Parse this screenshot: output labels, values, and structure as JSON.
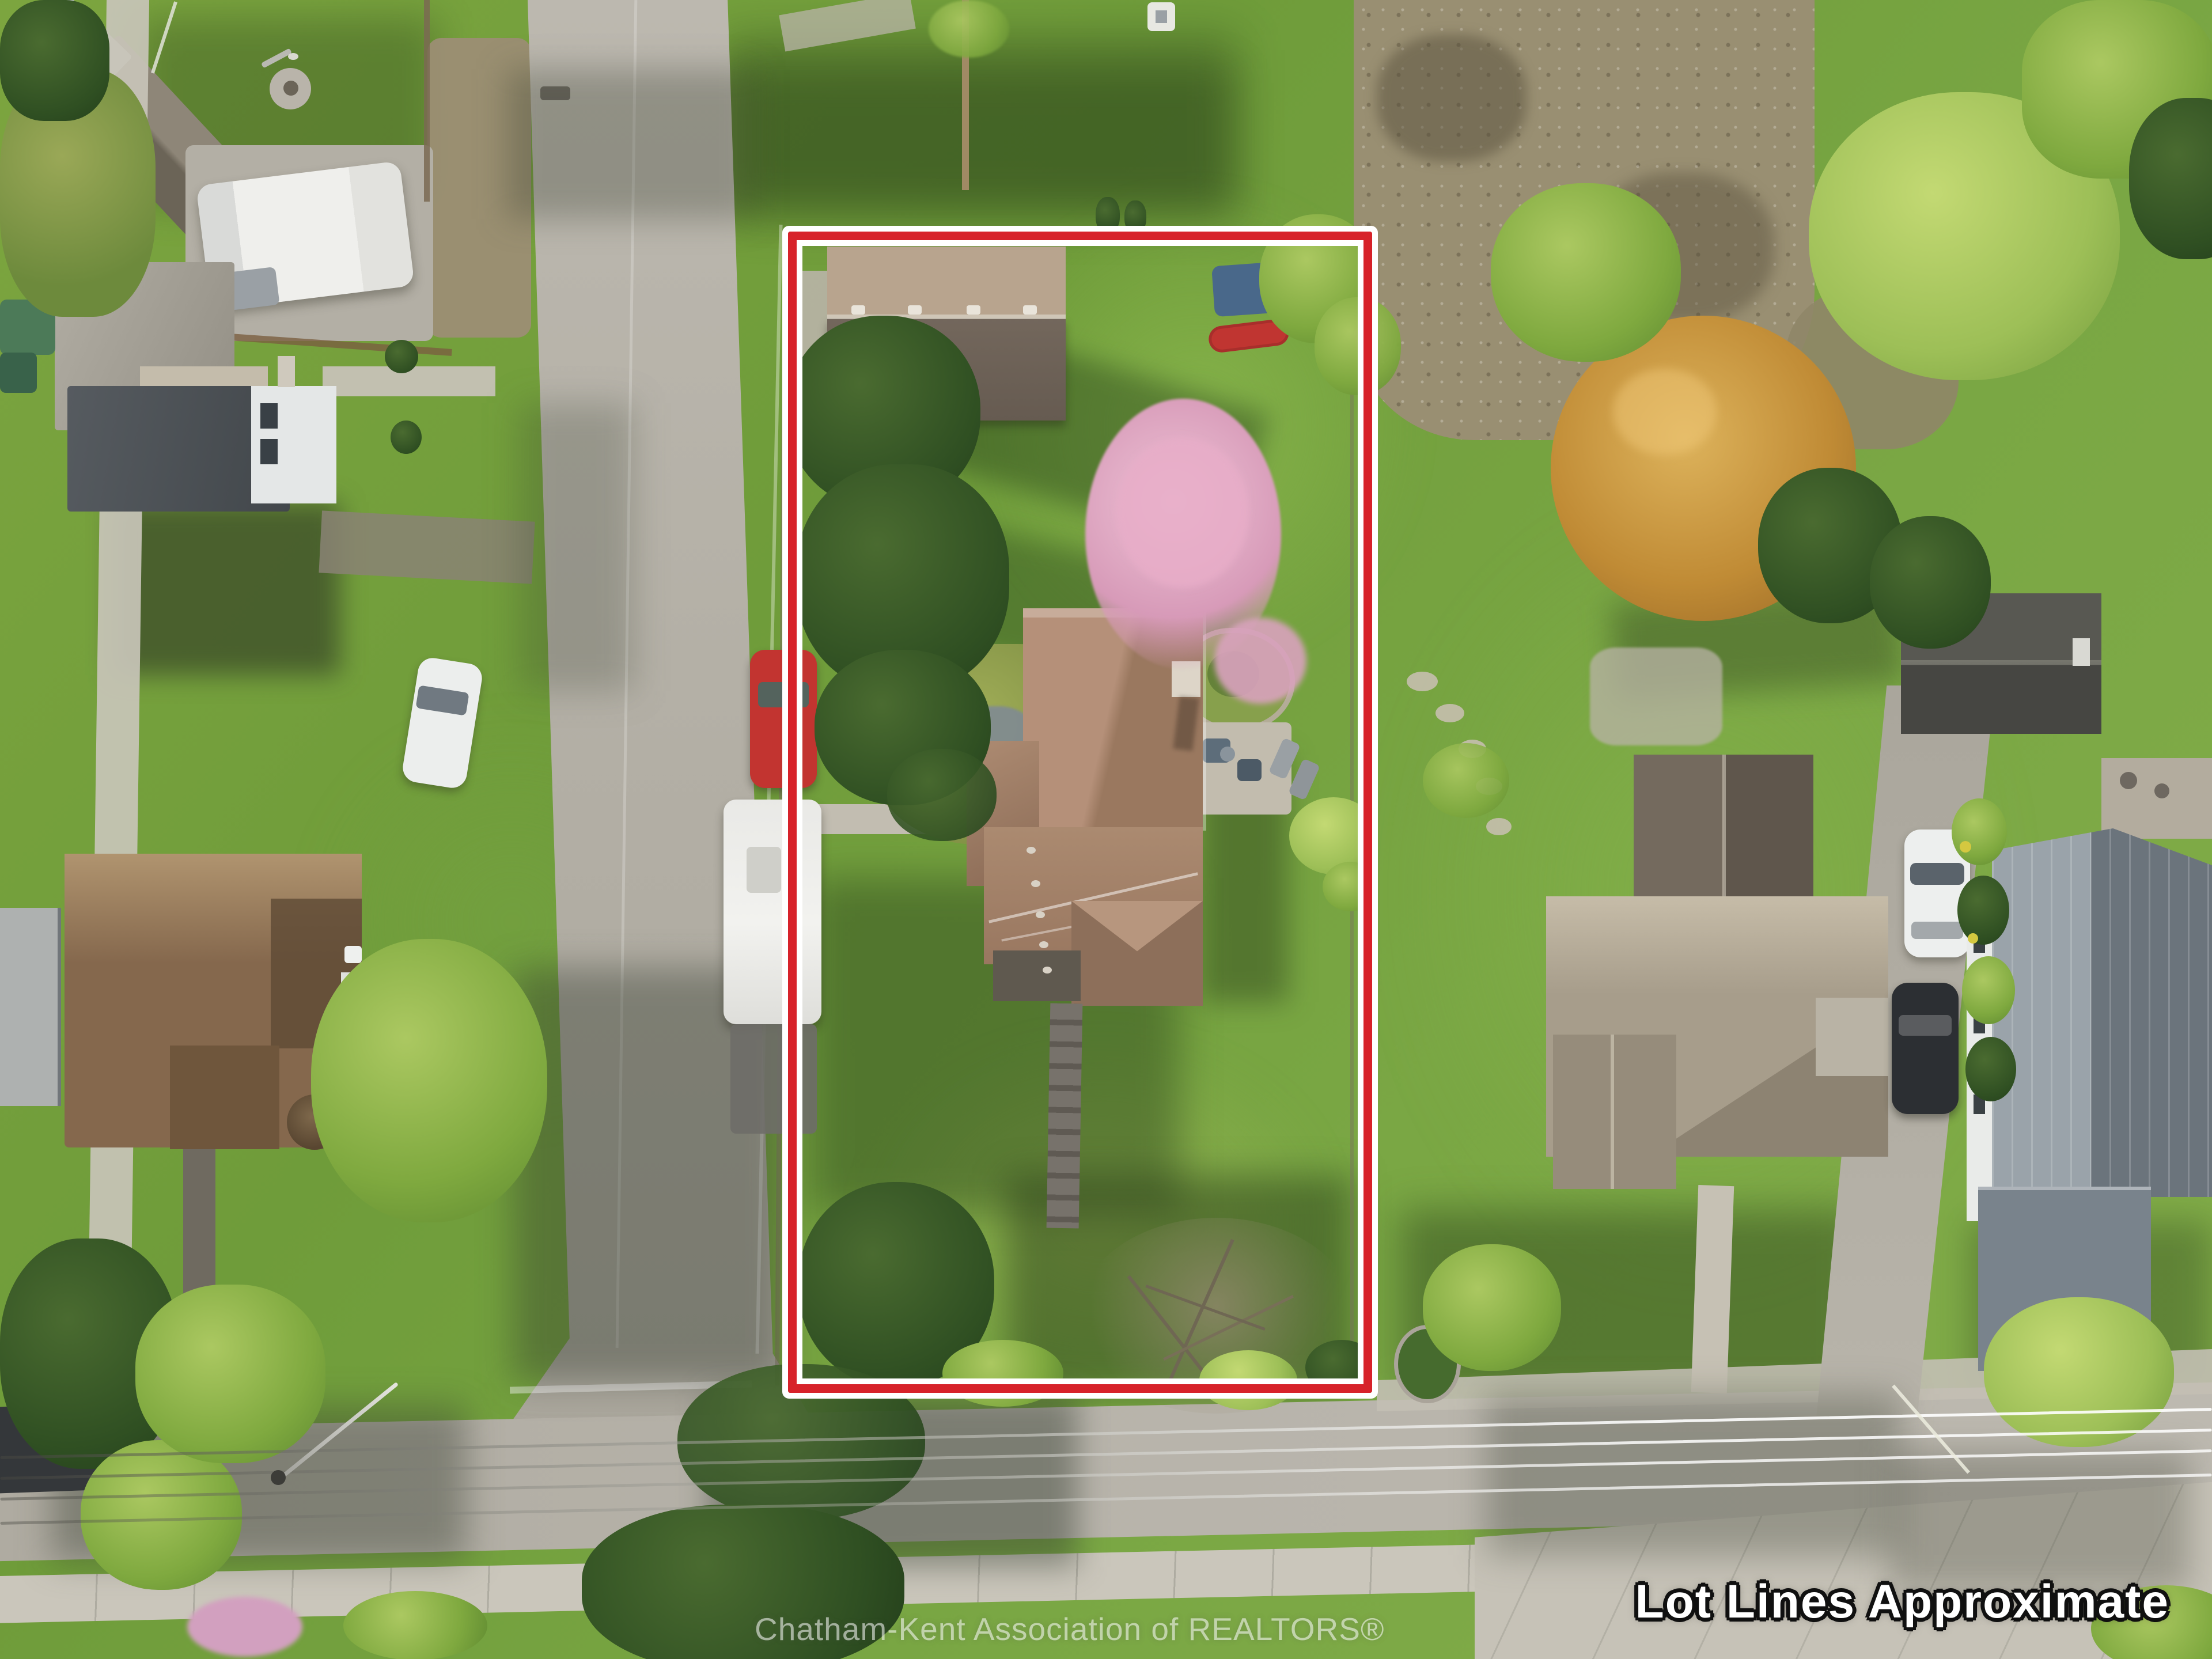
{
  "image": {
    "kind": "aerial drone photograph",
    "scene": "suburban residential neighbourhood, top-down view",
    "purpose": "real estate listing photo with highlighted property boundary"
  },
  "overlays": {
    "disclaimer_text": "Lot Lines Approximate",
    "watermark_text": "Chatham-Kent Association of REALTORS®"
  },
  "lot_outline": {
    "shape": "rectangle",
    "stroke_color": "#d7222a",
    "halo_color": "#ffffff"
  },
  "palette": {
    "lot_line": "#d7222a",
    "halo": "#ffffff",
    "lawn": "#79a742",
    "lawn_bright": "#8fbf52",
    "road": "#b4b0a6",
    "sidewalk": "#c9c5ba",
    "subject_roof": "#a3836e",
    "garage_roof_light": "#b8a48e",
    "garage_roof_dark": "#6e6358",
    "pink_blossom": "#d79ab8",
    "autumn_tree": "#c08b35",
    "conifer": "#2f4f22",
    "kayak_red": "#c03531"
  },
  "scene_objects": {
    "subject_lot": [
      "main house with brown shingle roof",
      "detached garage",
      "pink flowering tree",
      "stone garden path",
      "rock garden bed",
      "back patio with furniture",
      "red kayak",
      "blue tarp",
      "evergreen trees",
      "front walkway",
      "leafless tree and shrubs at street side"
    ],
    "streets": [
      "side street on the left",
      "main street at the bottom",
      "concrete sidewalks",
      "overhead power lines",
      "street light poles"
    ],
    "vehicles": [
      "red car parked on street",
      "white camper trailer parked on street",
      "white car parked at left house",
      "white car in right driveway",
      "black car in right driveway",
      "dark vehicle parked at bottom left"
    ],
    "neighbours": [
      "barn-style outbuilding top left",
      "grey Victorian house left",
      "tan Victorian house with turret bottom left",
      "tan hip-roof house right",
      "grey metal-roof house far right",
      "backyard shed top right",
      "large autumn-orange tree top right"
    ]
  }
}
